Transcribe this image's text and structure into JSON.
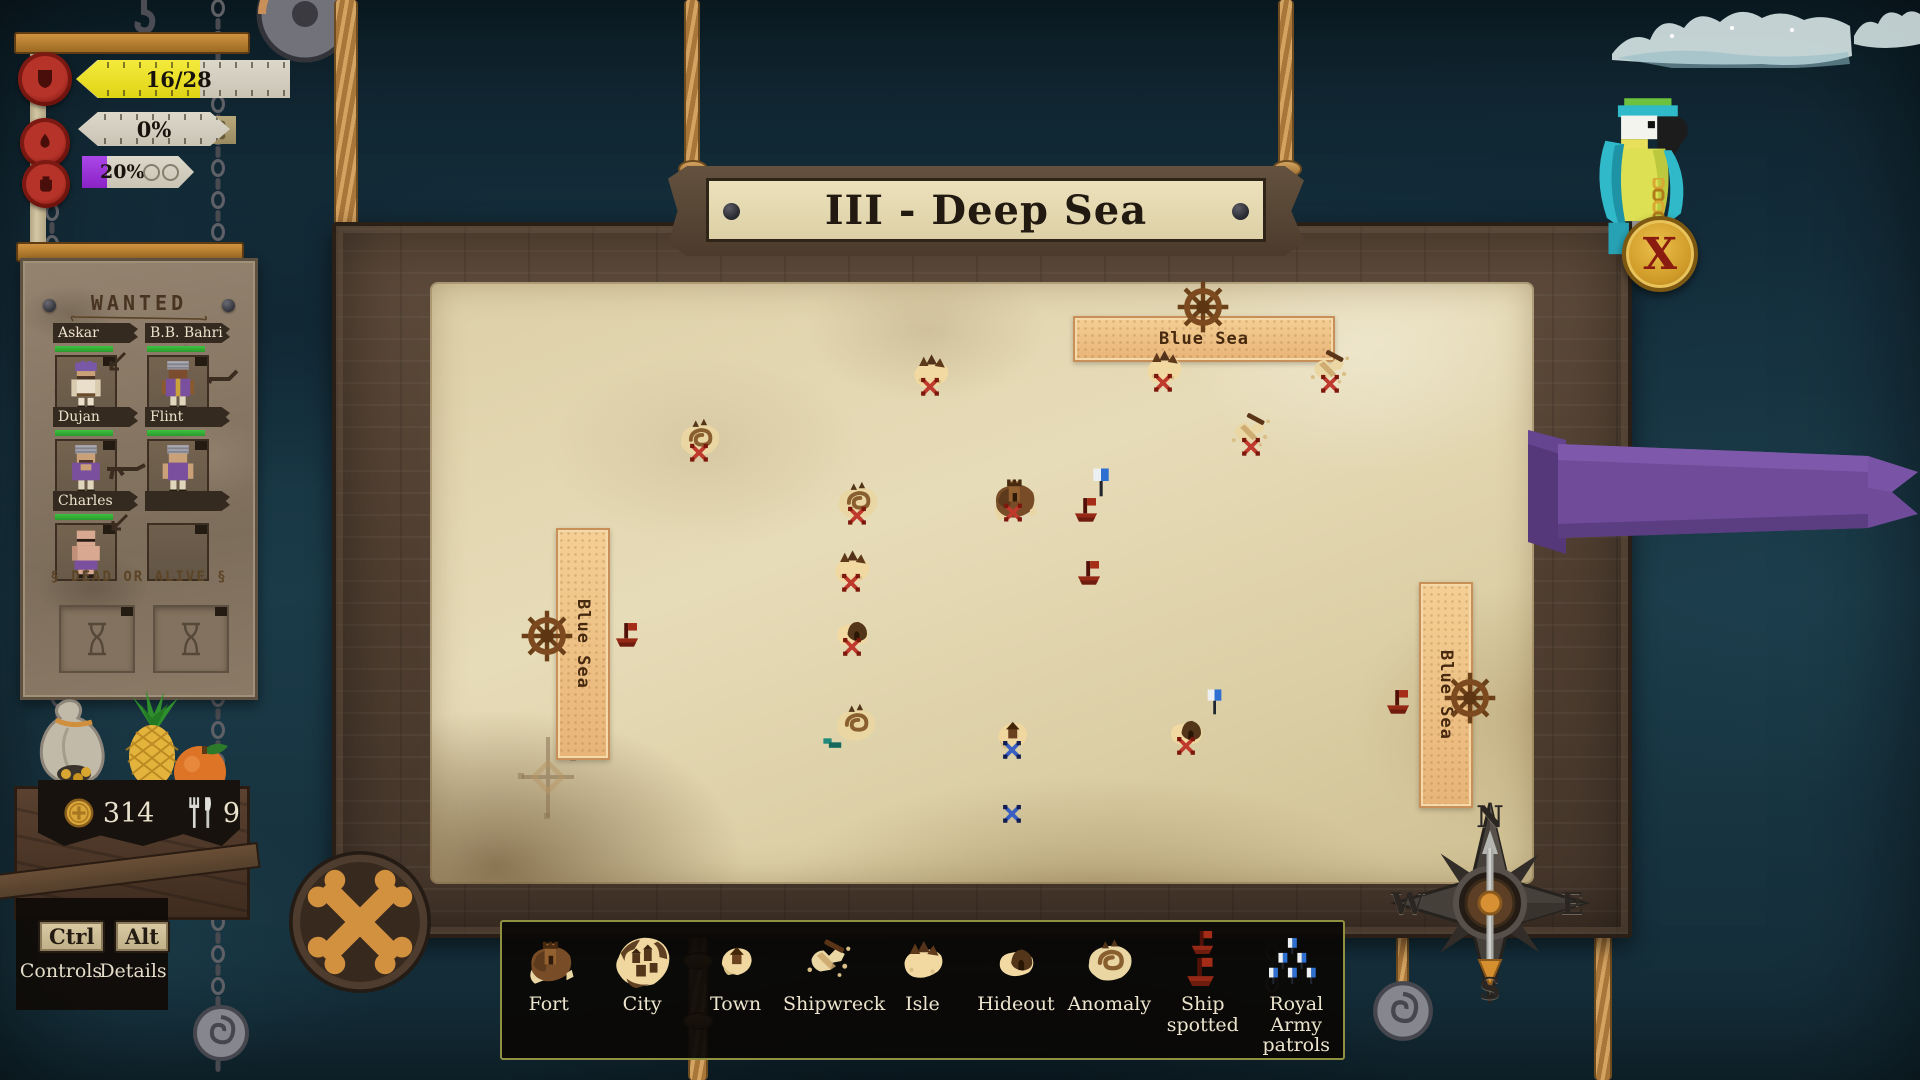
{
  "map": {
    "title": "III - Deep Sea",
    "sea_labels": [
      {
        "text": "Blue Sea",
        "orientation": "horizontal"
      },
      {
        "text": "Blue Sea",
        "orientation": "vertical-left"
      },
      {
        "text": "Blue Sea",
        "orientation": "vertical-right"
      }
    ],
    "markers": [
      {
        "type": "isle",
        "x": 930,
        "y": 377,
        "mark": "red-x"
      },
      {
        "type": "isle",
        "x": 1163,
        "y": 373,
        "mark": "red-x"
      },
      {
        "type": "shipwreck",
        "x": 1330,
        "y": 374,
        "mark": "red-x"
      },
      {
        "type": "anomaly",
        "x": 699,
        "y": 443,
        "mark": "red-x"
      },
      {
        "type": "shipwreck",
        "x": 1251,
        "y": 437,
        "mark": "red-x"
      },
      {
        "type": "anomaly",
        "x": 857,
        "y": 506,
        "mark": "red-x"
      },
      {
        "type": "fort",
        "x": 1013,
        "y": 503,
        "mark": "red-x"
      },
      {
        "type": "patrol-flag",
        "x": 1101,
        "y": 486
      },
      {
        "type": "ship-red",
        "x": 1086,
        "y": 514
      },
      {
        "type": "ship-red",
        "x": 1089,
        "y": 577
      },
      {
        "type": "isle",
        "x": 851,
        "y": 573,
        "mark": "red-x"
      },
      {
        "type": "hideout",
        "x": 852,
        "y": 637,
        "mark": "red-x"
      },
      {
        "type": "ship-red",
        "x": 627,
        "y": 639
      },
      {
        "type": "anomaly",
        "x": 855,
        "y": 728,
        "flag": "green"
      },
      {
        "type": "town",
        "x": 1012,
        "y": 740,
        "mark": "blue-x"
      },
      {
        "type": "hideout",
        "x": 1186,
        "y": 736,
        "mark": "red-x",
        "flag": "patrol"
      },
      {
        "type": "mark",
        "x": 1012,
        "y": 817,
        "mark": "blue-x"
      },
      {
        "type": "ship-red",
        "x": 1398,
        "y": 706
      }
    ]
  },
  "stats": {
    "bars": [
      {
        "value": "16/28",
        "fill_pct": 58,
        "fill_color": "#f0e626",
        "icon": "shield-icon"
      },
      {
        "value": "0%",
        "fill_pct": 0,
        "fill_color": "#d6d2c4",
        "icon": "flame-icon"
      },
      {
        "value": "20%",
        "fill_pct": 22,
        "fill_color": "#9b2fd6",
        "icon": "jug-icon",
        "empty_slots": 2
      }
    ]
  },
  "wanted": {
    "title": "WANTED",
    "subtitle": "§ DEAD OR ALIVE §",
    "bounties": [
      {
        "name": "Askar",
        "health_pct": 100,
        "variant": "askar"
      },
      {
        "name": "B.B. Bahri",
        "health_pct": 100,
        "variant": "bahri"
      },
      {
        "name": "Dujan",
        "health_pct": 100,
        "variant": "dujan"
      },
      {
        "name": "Flint",
        "health_pct": 100,
        "variant": "flint"
      },
      {
        "name": "Charles",
        "health_pct": 100,
        "variant": "charles"
      },
      {
        "name": "",
        "variant": "empty"
      }
    ],
    "pending_slots": 2
  },
  "resources": {
    "gold": "314",
    "food": "9"
  },
  "hotkeys": {
    "ctrl_key": "Ctrl",
    "ctrl_action": "Controls",
    "alt_key": "Alt",
    "alt_action": "Details"
  },
  "compass": {
    "north": "N",
    "east": "E",
    "south": "S",
    "west": "W"
  },
  "close_button": {
    "label": "X"
  },
  "legend": {
    "items": [
      {
        "id": "fort",
        "label": "Fort"
      },
      {
        "id": "city",
        "label": "City"
      },
      {
        "id": "town",
        "label": "Town"
      },
      {
        "id": "shipwreck",
        "label": "Shipwreck"
      },
      {
        "id": "isle",
        "label": "Isle"
      },
      {
        "id": "hideout",
        "label": "Hideout"
      },
      {
        "id": "anomaly",
        "label": "Anomaly"
      },
      {
        "id": "ship-spotted",
        "label": "Ship spotted"
      },
      {
        "id": "royal-patrols",
        "label": "Royal Army patrols"
      }
    ]
  },
  "colors": {
    "bounty_bar_fill": "#f0e626",
    "quest_bar_fill": "#9b2fd6",
    "health_bar": "#2fae32",
    "enemy_mark": "#bf3a2c",
    "ally_mark": "#3a5fc0",
    "legend_border": "#8f9040"
  }
}
